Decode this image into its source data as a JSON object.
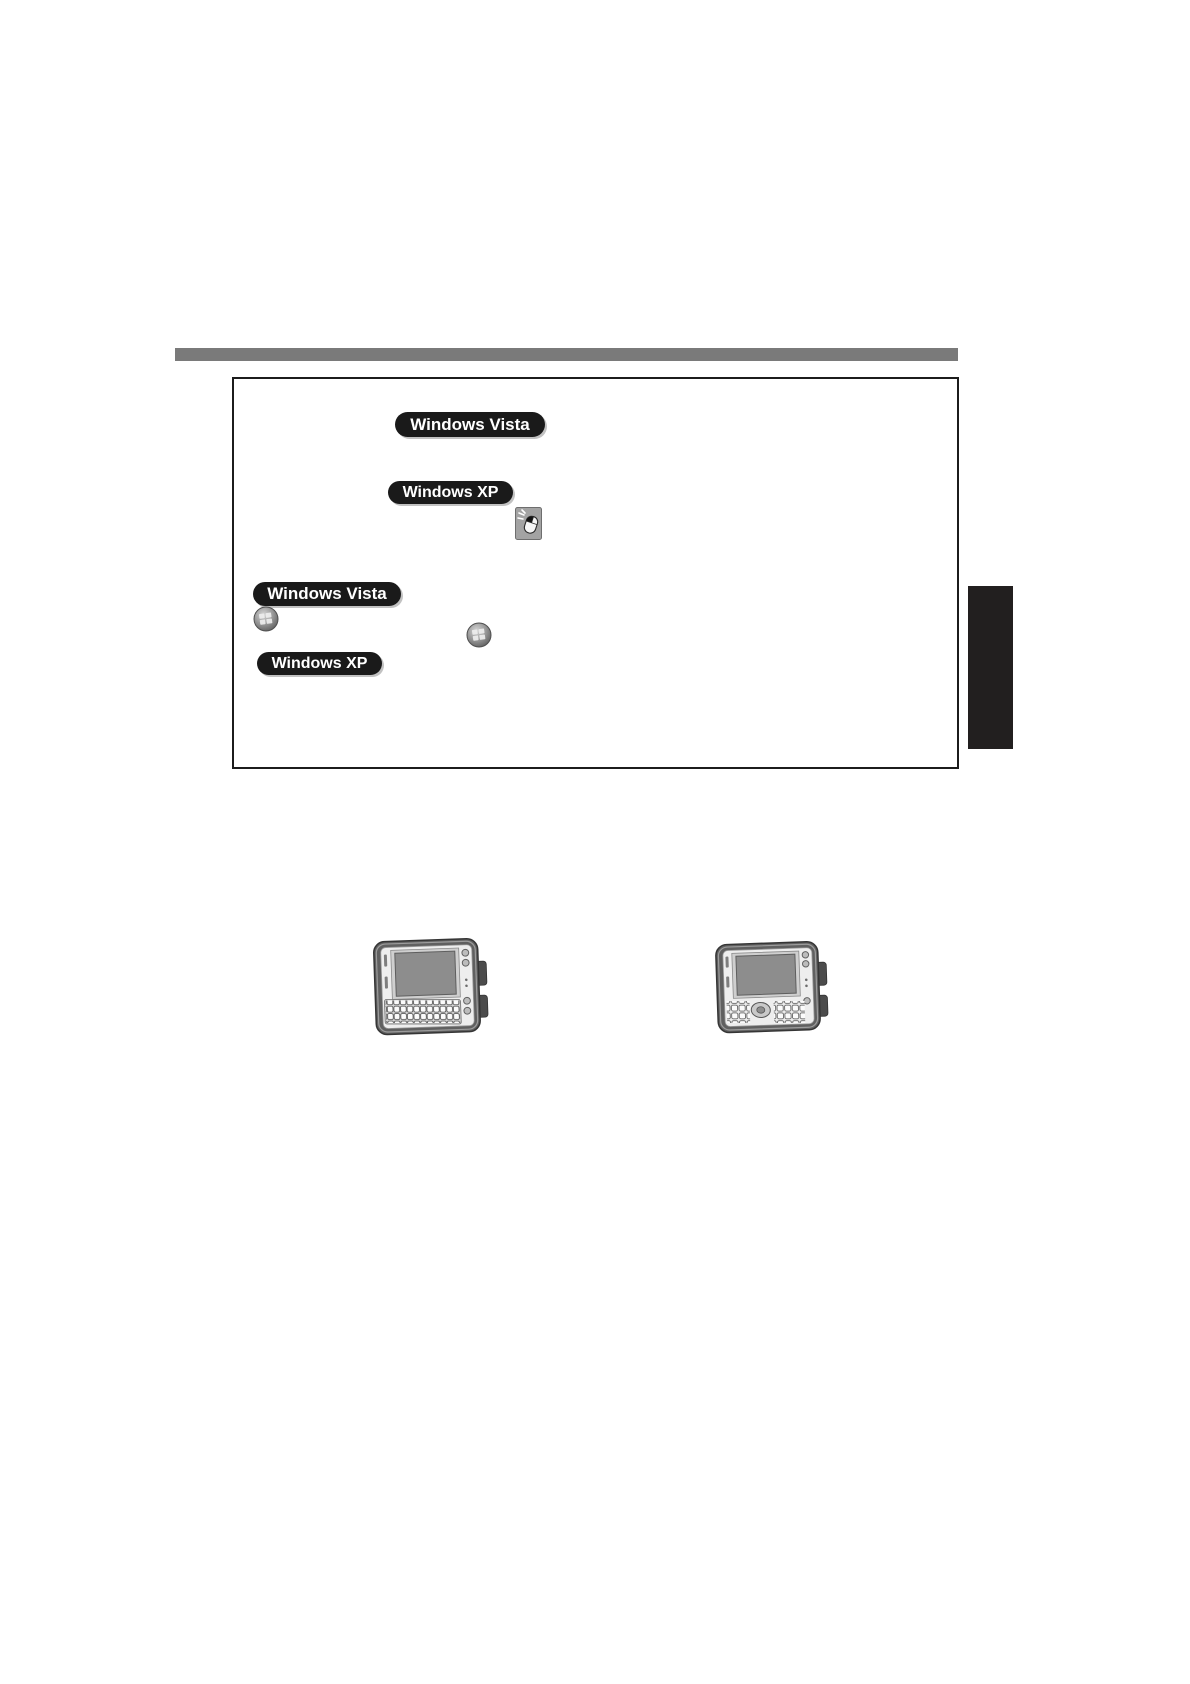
{
  "document": {
    "kind": "scanned-manual-page",
    "background": "#ffffff"
  },
  "header_bar": {
    "color": "#7a7a7a"
  },
  "callout_box": {
    "border_color": "#1c1c1c"
  },
  "badges": {
    "background": "#1a1a1a",
    "text_color": "#ffffff",
    "vista_label": "Windows Vista",
    "xp_label": "Windows XP"
  },
  "icons": {
    "mouse_click": "mouse-left-click-icon",
    "windows_orb": "windows-start-orb-icon"
  },
  "side_tab": {
    "color": "#221f1f"
  },
  "figures": {
    "left_device": "rugged-tablet-qwerty-keyboard",
    "right_device": "rugged-tablet-numeric-keypad"
  }
}
